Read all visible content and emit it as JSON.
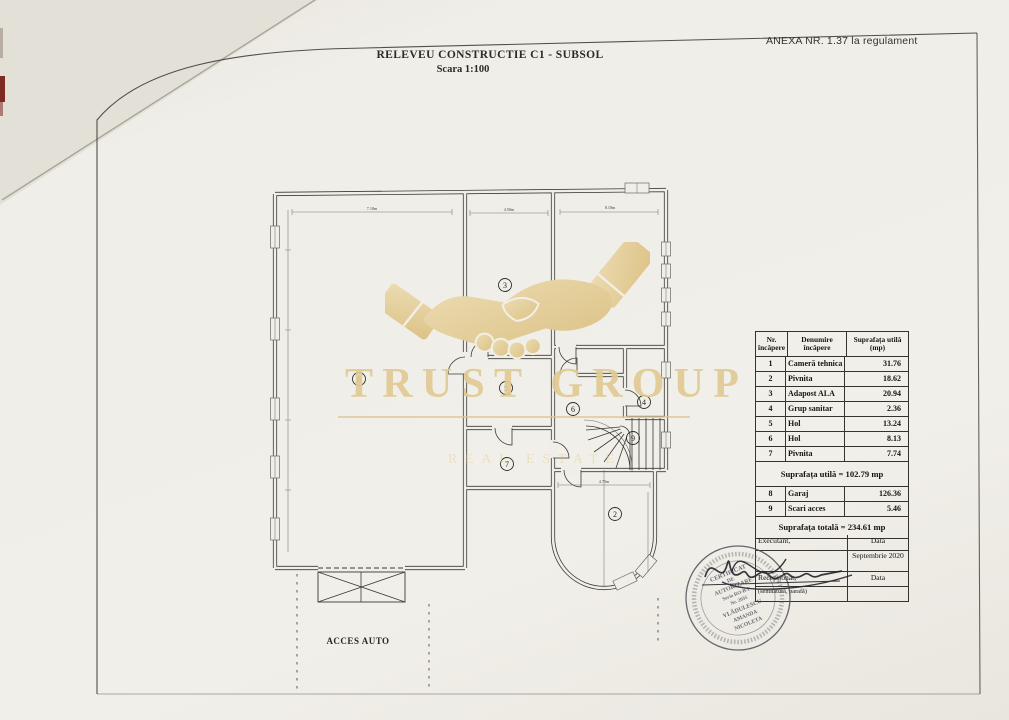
{
  "document": {
    "annex_note": "ANEXA NR. 1.37 la regulament",
    "title": "RELEVEU CONSTRUCTIE C1 - SUBSOL",
    "scale": "Scara 1:100"
  },
  "plan": {
    "room_labels": [
      "1",
      "2",
      "3",
      "4",
      "5",
      "6",
      "7",
      "8",
      "9"
    ],
    "access_label": "ACCES AUTO",
    "dimensions": [
      "7.10m",
      "4.50m",
      "8.10m",
      "4.75m"
    ]
  },
  "watermark": {
    "brand": "TRUST GROUP",
    "brand_sub": "REAL ESTATE",
    "gold_color": "#e1cb94"
  },
  "area_table": {
    "col_headers": [
      "Nr. încăpere",
      "Denumire încăpere",
      "Suprafața utilă (mp)"
    ],
    "rows": [
      {
        "nr": "1",
        "name": "Cameră tehnica",
        "area": "31.76"
      },
      {
        "nr": "2",
        "name": "Pivnita",
        "area": "18.62"
      },
      {
        "nr": "3",
        "name": "Adapost ALA",
        "area": "20.94"
      },
      {
        "nr": "4",
        "name": "Grup sanitar",
        "area": "2.36"
      },
      {
        "nr": "5",
        "name": "Hol",
        "area": "13.24"
      },
      {
        "nr": "6",
        "name": "Hol",
        "area": "8.13"
      },
      {
        "nr": "7",
        "name": "Pivnita",
        "area": "7.74"
      }
    ],
    "subtotal_text": "Suprafața utilă = 102.79 mp",
    "extra_rows": [
      {
        "nr": "8",
        "name": "Garaj",
        "area": "126.36"
      },
      {
        "nr": "9",
        "name": "Scari acces",
        "area": "5.46"
      }
    ],
    "total_text": "Suprafața totală = 234.61 mp"
  },
  "signoff": {
    "executant_label": "Executant,",
    "date_label": "Data",
    "date_value": "Septembrie 2020",
    "received_label": "Recepționat,",
    "received_date_label": "Data",
    "note": "(semnătură, parafă)"
  },
  "stamp": {
    "line1": "CERTIFICAT",
    "line2": "DE",
    "line3": "AUTORIZARE",
    "line4": "Seria RO-B-F",
    "line5": "Nr. 2035",
    "line6": "VLĂDULESCU",
    "line7": "AMANDA",
    "line8": "NICOLETA"
  }
}
